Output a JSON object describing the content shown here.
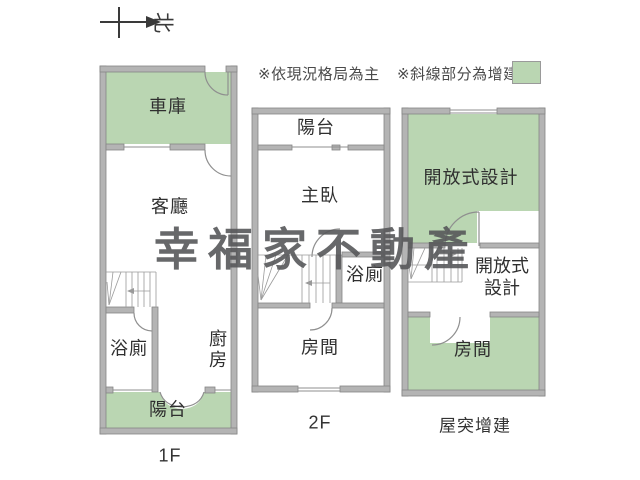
{
  "compass": {
    "north_label": "北"
  },
  "notes": {
    "note_layout": "※依現況格局為主",
    "note_addition": "※斜線部分為增建"
  },
  "legend": {
    "addition_color": "#bad6b2"
  },
  "watermark": "幸福家不動產",
  "floor_1f": {
    "name": "1F",
    "garage": "車庫",
    "living_room": "客廳",
    "bathroom": "浴廁",
    "kitchen": "廚房",
    "balcony": "陽台"
  },
  "floor_2f": {
    "name": "2F",
    "balcony": "陽台",
    "master_bedroom": "主臥",
    "bathroom": "浴廁",
    "room": "房間"
  },
  "floor_roof": {
    "name": "屋突增建",
    "open_design_upper": "開放式設計",
    "open_design_lower": "開放式設計",
    "room": "房間"
  }
}
